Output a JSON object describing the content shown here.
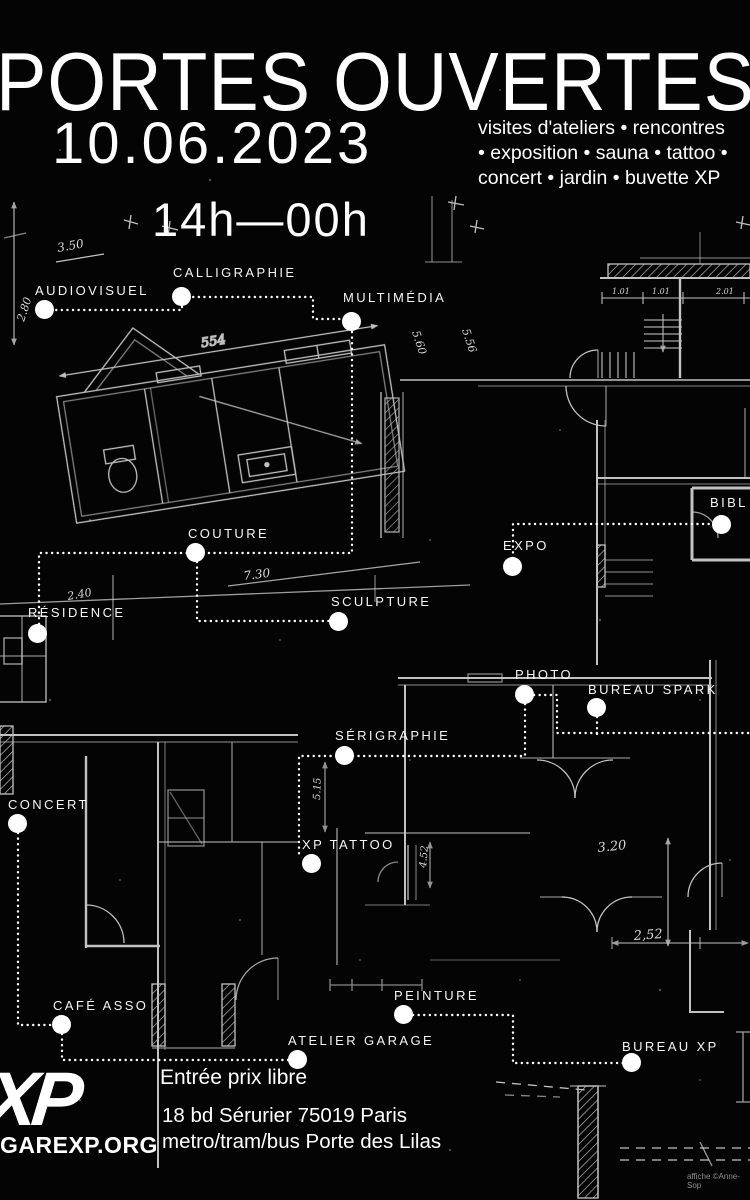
{
  "poster": {
    "title": "PORTES OUVERTES",
    "date": "10.06.2023",
    "time": "14h—00h",
    "activities": [
      "visites d'ateliers • rencontres",
      "• exposition • sauna • tattoo •",
      "concert • jardin • buvette XP"
    ],
    "entry": "Entrée prix libre",
    "address": "18 bd Sérurier 75019 Paris",
    "transit": "metro/tram/bus Porte des Lilas",
    "logo": "XP",
    "website": "GAREXP.ORG",
    "credit": "affiche ©Anne-Sop"
  },
  "rooms": [
    {
      "label": "AUDIOVISUEL"
    },
    {
      "label": "CALLIGRAPHIE"
    },
    {
      "label": "MULTIMÉDIA"
    },
    {
      "label": "COUTURE"
    },
    {
      "label": "EXPO"
    },
    {
      "label": "RÉSIDENCE"
    },
    {
      "label": "SCULPTURE"
    },
    {
      "label": "PHOTO"
    },
    {
      "label": "BUREAU SPARK"
    },
    {
      "label": "SÉRIGRAPHIE"
    },
    {
      "label": "CONCERT"
    },
    {
      "label": "XP TATTOO"
    },
    {
      "label": "CAFÉ ASSO"
    },
    {
      "label": "PEINTURE"
    },
    {
      "label": "ATELIER GARAGE"
    },
    {
      "label": "BUREAU XP"
    },
    {
      "label": "BIBL"
    }
  ],
  "blueprint": {
    "dimensions": [
      "3.50",
      "2.80",
      "554",
      "5.56",
      "5.60",
      "2.40",
      "7.30",
      "1.01",
      "1.01",
      "2.01",
      "5.15",
      "4.52",
      "3.20",
      "2,52"
    ]
  },
  "colors": {
    "background": "#040404",
    "ink": "#ffffff",
    "plan_line": "#d9d9d9",
    "credit": "#8f8f8f"
  }
}
